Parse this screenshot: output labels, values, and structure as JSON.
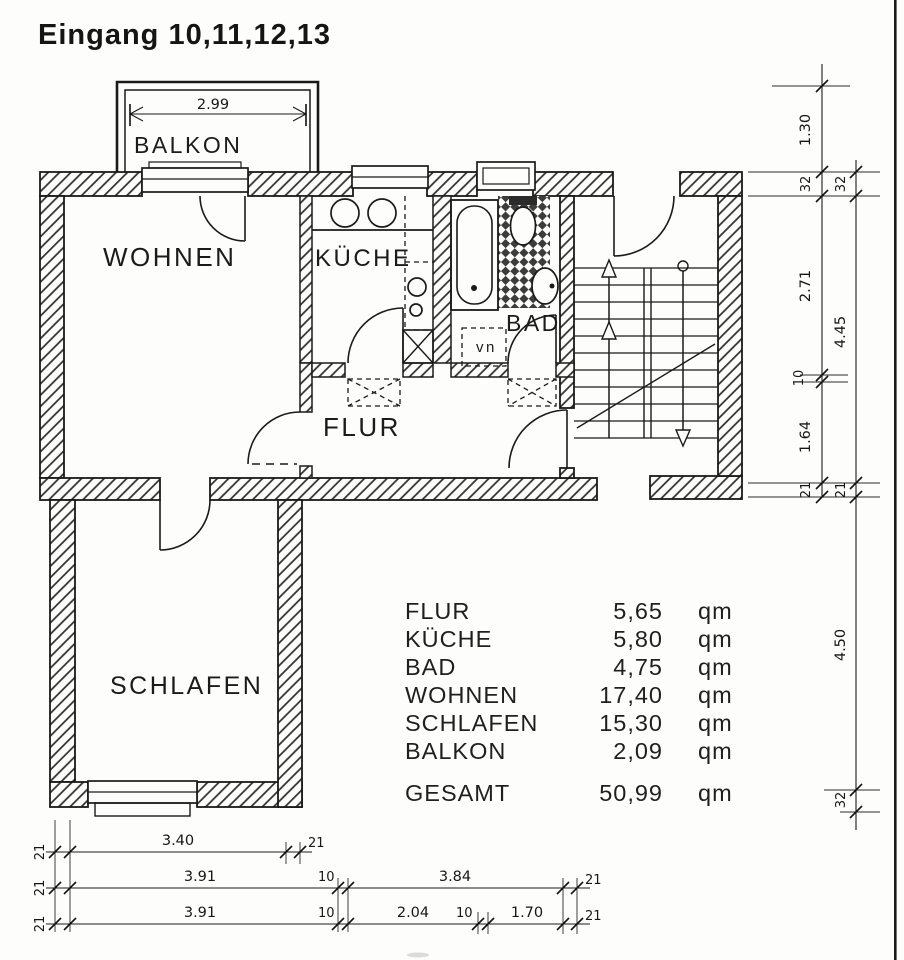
{
  "title": "Eingang 10,11,12,13",
  "rooms": {
    "balkon": "BALKON",
    "wohnen": "WOHNEN",
    "kueche": "KÜCHE",
    "bad": "BAD",
    "flur": "FLUR",
    "schlafen": "SCHLAFEN",
    "niche": "vn"
  },
  "area_table": {
    "rows": [
      {
        "label": "FLUR",
        "value": "5,65",
        "unit": "qm"
      },
      {
        "label": "KÜCHE",
        "value": "5,80",
        "unit": "qm"
      },
      {
        "label": "BAD",
        "value": "4,75",
        "unit": "qm"
      },
      {
        "label": "WOHNEN",
        "value": "17,40",
        "unit": "qm"
      },
      {
        "label": "SCHLAFEN",
        "value": "15,30",
        "unit": "qm"
      },
      {
        "label": "BALKON",
        "value": "2,09",
        "unit": "qm"
      }
    ],
    "total": {
      "label": "GESAMT",
      "value": "50,99",
      "unit": "qm"
    }
  },
  "dimensions": {
    "balcony_width": "2.99",
    "right_inner": [
      "1.30",
      "32",
      "2.71",
      "10",
      "1.64",
      "21"
    ],
    "right_outer": [
      "32",
      "4.45",
      "21",
      "4.50",
      "32"
    ],
    "bottom_row1": [
      "21",
      "3.40",
      "21"
    ],
    "bottom_row2": [
      "21",
      "3.91",
      "10",
      "3.84",
      "21"
    ],
    "bottom_row3": [
      "21",
      "3.91",
      "10",
      "2.04",
      "10",
      "1.70",
      "21"
    ]
  },
  "colors": {
    "ink": "#1a1a1a",
    "paper": "#fdfdfb"
  }
}
